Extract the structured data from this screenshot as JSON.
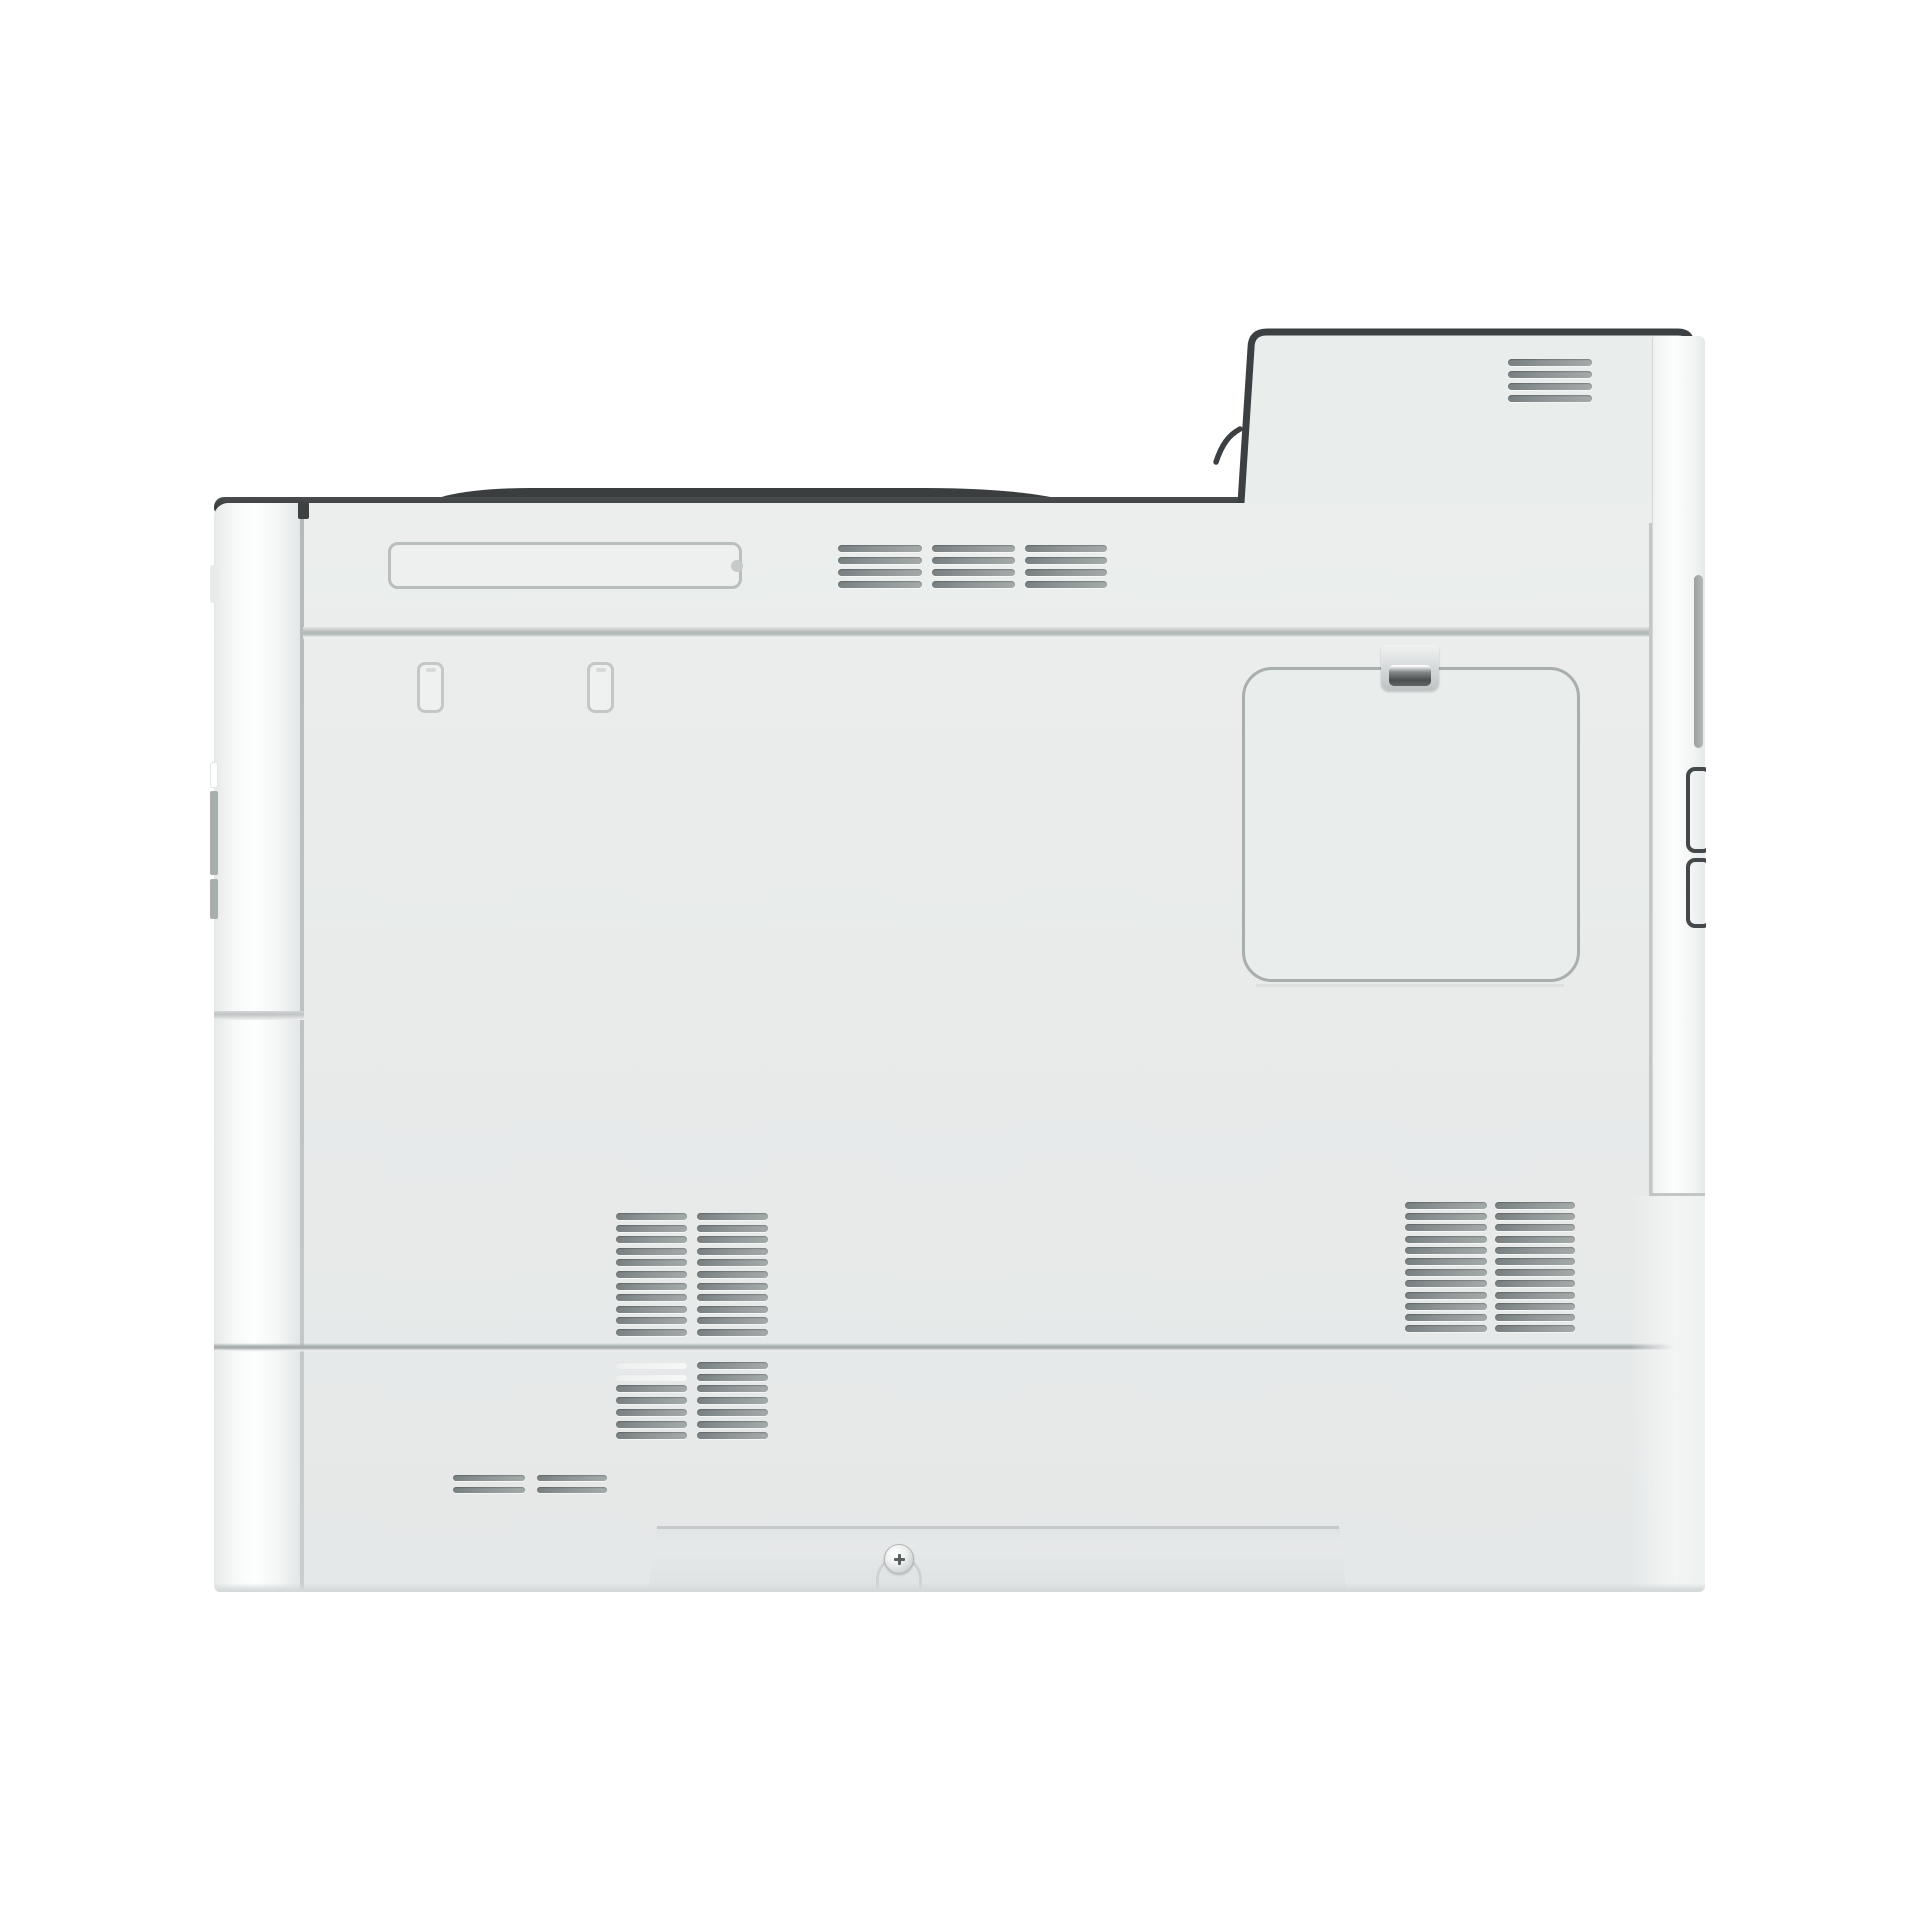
{
  "meta": {
    "subject": "white laser printer, right-side panel view",
    "text_visible": false
  },
  "colors": {
    "background": "#ffffff",
    "panel": "#e8ebea",
    "panel_light": "#eef1f0",
    "dark_trim": "#3c4042",
    "seam": "#aab0b0",
    "outline": "#a9aeae",
    "strip_white": "#fbfcfc",
    "slat_dark": "#798082",
    "slat_mid": "#8f9596",
    "slat_light": "#a4a9a9"
  },
  "components": [
    "top-dark-trim",
    "rear-corner-protrusion",
    "corner-vent",
    "carry-handle-slot",
    "top-vent",
    "toner-door",
    "door-latch-clip",
    "mid-left-vent",
    "mid-right-vent",
    "bottom-vent",
    "exhaust-dashes",
    "front-edge-strip",
    "rear-edge-strip",
    "interface-slot-covers",
    "base-recess",
    "base-screw"
  ],
  "vents": [
    {
      "name": "corner-vent",
      "x": 1508,
      "y": 359,
      "cols": [
        84
      ],
      "col_gap": 0,
      "rows": 4,
      "row_pitch": 12,
      "slat_h": 7
    },
    {
      "name": "top-vent",
      "x": 838,
      "y": 545,
      "cols": [
        84,
        83,
        82
      ],
      "col_gap": 10,
      "rows": 4,
      "row_pitch": 12,
      "slat_h": 7
    },
    {
      "name": "mid-left-vent",
      "x": 616,
      "y": 1213,
      "cols": [
        71,
        71
      ],
      "col_gap": 10,
      "rows": 11,
      "row_pitch": 11.6,
      "slat_h": 7
    },
    {
      "name": "mid-right-vent",
      "x": 1405,
      "y": 1202,
      "cols": [
        82,
        80
      ],
      "col_gap": 8,
      "rows": 12,
      "row_pitch": 11.2,
      "slat_h": 7
    },
    {
      "name": "bottom-vent",
      "x": 616,
      "y": 1362,
      "cols": [
        71,
        71
      ],
      "col_gap": 10,
      "rows": 7,
      "row_pitch": 11.7,
      "slat_h": 7,
      "light": [
        "0-0",
        "0-1"
      ]
    },
    {
      "name": "exhaust-dashes",
      "x": 453,
      "y": 1475,
      "cols": [
        72,
        70
      ],
      "col_gap": 12,
      "rows": 2,
      "row_pitch": 12,
      "slat_h": 6
    }
  ]
}
